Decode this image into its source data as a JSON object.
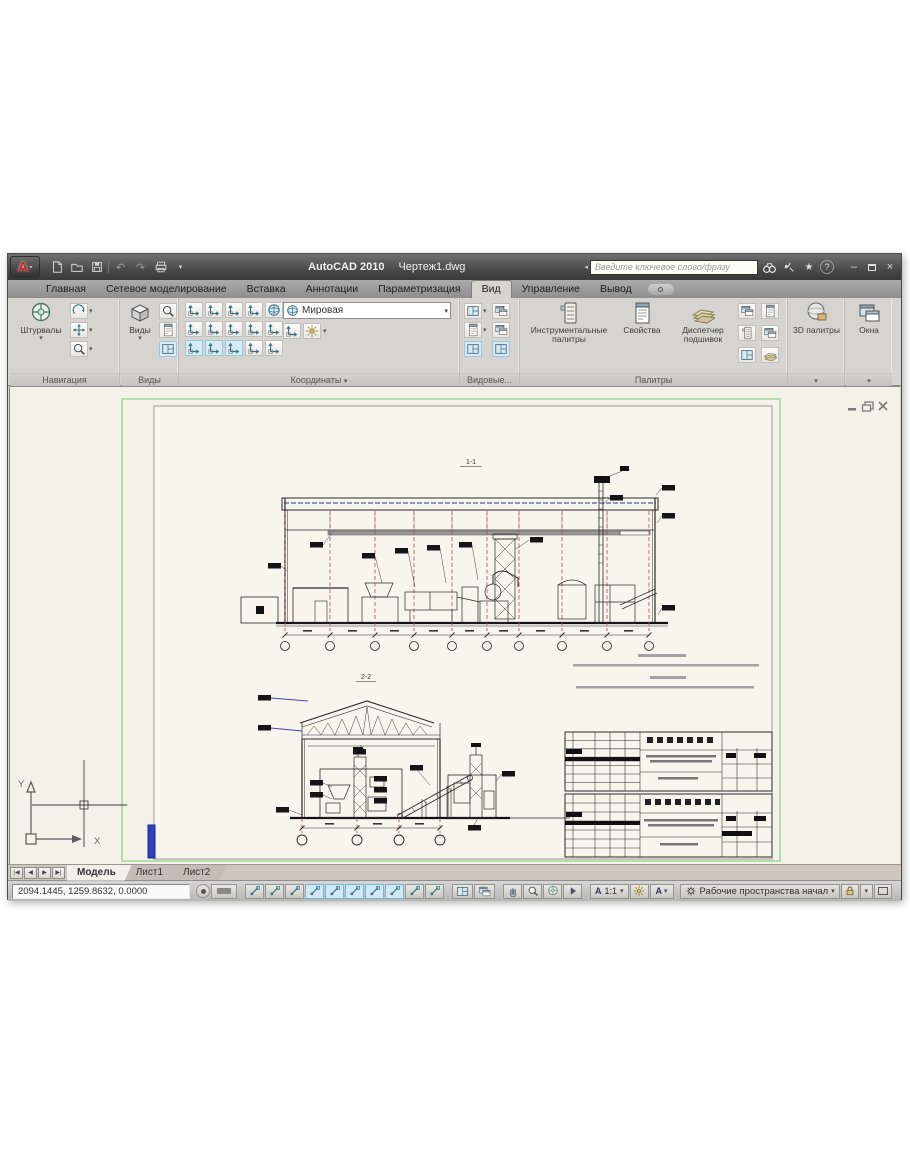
{
  "titlebar": {
    "app_title": "AutoCAD 2010",
    "doc_name": "Чертеж1.dwg",
    "search_placeholder": "Введите ключевое слово/фразу",
    "icons": {
      "minimize": "–",
      "close": "×"
    }
  },
  "ribbon_tabs": {
    "items": [
      "Главная",
      "Сетевое моделирование",
      "Вставка",
      "Аннотации",
      "Параметризация",
      "Вид",
      "Управление",
      "Вывод"
    ],
    "active": "Вид"
  },
  "ribbon": {
    "navigate": {
      "label": "Навигация",
      "wheels": "Штурвалы"
    },
    "views": {
      "label": "Виды",
      "views_btn": "Виды"
    },
    "coordinates": {
      "label": "Координаты",
      "ucs_combo": "Мировая"
    },
    "viewports": {
      "label": "Видовые..."
    },
    "palettes": {
      "label": "Палитры",
      "tool_palettes": "Инструментальные палитры",
      "properties": "Свойства",
      "sheet_set_manager": "Диспетчер подшивок"
    },
    "palettes_3d": {
      "button": "3D палитры"
    },
    "windows": {
      "button": "Окна"
    }
  },
  "canvas": {
    "section_top": "1-1",
    "section_bottom": "2-2",
    "ucs_y": "Y",
    "ucs_x": "X"
  },
  "layout_tabs": {
    "items": [
      "Модель",
      "Лист1",
      "Лист2"
    ],
    "active": "Модель"
  },
  "statusbar": {
    "coordinates": "2094.1445, 1259.8632, 0.0000",
    "annotation_scale": "1:1",
    "workspace": "Рабочие пространства начал",
    "toggles": [
      {
        "name": "snap",
        "pressed": false
      },
      {
        "name": "grid",
        "pressed": false
      },
      {
        "name": "ortho",
        "pressed": false
      },
      {
        "name": "polar",
        "pressed": true
      },
      {
        "name": "osnap",
        "pressed": true
      },
      {
        "name": "otrack",
        "pressed": true
      },
      {
        "name": "ducs",
        "pressed": true
      },
      {
        "name": "dyn",
        "pressed": true
      },
      {
        "name": "lwt",
        "pressed": false
      },
      {
        "name": "qp",
        "pressed": false
      }
    ]
  },
  "colors": {
    "limits_border": "#a6d9a0",
    "grid_line_red": "#a05252",
    "marker_blue": "#2f3fbe",
    "canvas_bg": "#f3f1e8"
  }
}
